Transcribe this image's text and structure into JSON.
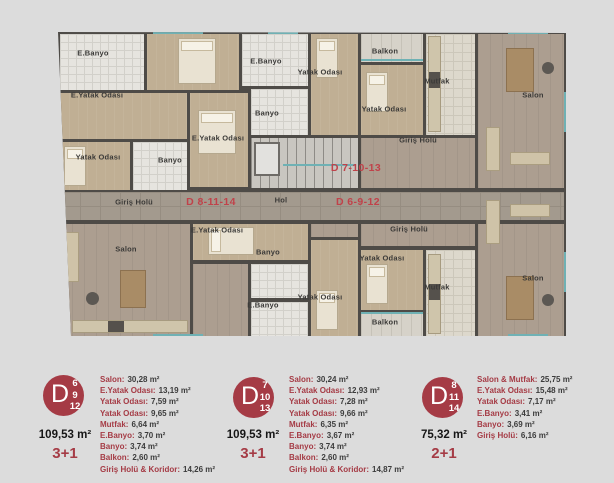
{
  "plan": {
    "room_labels": [
      {
        "text": "E.Banyo",
        "x": 35,
        "y": 21
      },
      {
        "text": "E.Yatak Odası",
        "x": 39,
        "y": 63
      },
      {
        "text": "Yatak Odası",
        "x": 40,
        "y": 125
      },
      {
        "text": "Banyo",
        "x": 112,
        "y": 128
      },
      {
        "text": "E.Banyo",
        "x": 208,
        "y": 29
      },
      {
        "text": "Yatak Odası",
        "x": 262,
        "y": 40
      },
      {
        "text": "Balkon",
        "x": 327,
        "y": 19
      },
      {
        "text": "Banyo",
        "x": 209,
        "y": 81
      },
      {
        "text": "Yatak Odası",
        "x": 326,
        "y": 77
      },
      {
        "text": "E.Yatak Odası",
        "x": 160,
        "y": 106
      },
      {
        "text": "Giriş Holü",
        "x": 360,
        "y": 108
      },
      {
        "text": "Mutfak",
        "x": 379,
        "y": 49
      },
      {
        "text": "Salon",
        "x": 475,
        "y": 63
      },
      {
        "text": "Giriş Holü",
        "x": 76,
        "y": 170
      },
      {
        "text": "Hol",
        "x": 223,
        "y": 168
      },
      {
        "text": "E.Yatak Odası",
        "x": 159,
        "y": 198
      },
      {
        "text": "Banyo",
        "x": 210,
        "y": 220
      },
      {
        "text": "Yatak Odası",
        "x": 324,
        "y": 226
      },
      {
        "text": "Giriş Holü",
        "x": 351,
        "y": 197
      },
      {
        "text": "Salon",
        "x": 68,
        "y": 217
      },
      {
        "text": "Yatak Odası",
        "x": 262,
        "y": 265
      },
      {
        "text": "E.Banyo",
        "x": 205,
        "y": 273
      },
      {
        "text": "Balkon",
        "x": 327,
        "y": 290
      },
      {
        "text": "Mutfak",
        "x": 379,
        "y": 255
      },
      {
        "text": "Salon",
        "x": 475,
        "y": 246
      }
    ],
    "unit_labels": [
      {
        "text": "D 8-11-14",
        "x": 153,
        "y": 170
      },
      {
        "text": "D 7-10-13",
        "x": 298,
        "y": 136
      },
      {
        "text": "D 6-9-12",
        "x": 300,
        "y": 170
      }
    ]
  },
  "units": [
    {
      "badge": {
        "letter": "D",
        "floors": [
          "6",
          "9",
          "12"
        ]
      },
      "rooms": [
        {
          "label": "Salon",
          "value": "30,28 m²"
        },
        {
          "label": "E.Yatak Odası",
          "value": "13,19 m²"
        },
        {
          "label": "Yatak Odası",
          "value": "7,59 m²"
        },
        {
          "label": "Yatak Odası",
          "value": "9,65 m²"
        },
        {
          "label": "Mutfak",
          "value": "6,64 m²"
        },
        {
          "label": "E.Banyo",
          "value": "3,70 m²"
        },
        {
          "label": "Banyo",
          "value": "3,74 m²"
        },
        {
          "label": "Balkon",
          "value": "2,60 m²"
        },
        {
          "label": "Giriş Holü & Koridor",
          "value": "14,26 m²"
        }
      ],
      "total": "109,53 m²",
      "type": "3+1"
    },
    {
      "badge": {
        "letter": "D",
        "floors": [
          "7",
          "10",
          "13"
        ]
      },
      "rooms": [
        {
          "label": "Salon",
          "value": "30,24 m²"
        },
        {
          "label": "E.Yatak Odası",
          "value": "12,93 m²"
        },
        {
          "label": "Yatak Odası",
          "value": "7,28 m²"
        },
        {
          "label": "Yatak Odası",
          "value": "9,66 m²"
        },
        {
          "label": "Mutfak",
          "value": "6,35 m²"
        },
        {
          "label": "E.Banyo",
          "value": "3,67 m²"
        },
        {
          "label": "Banyo",
          "value": "3,74 m²"
        },
        {
          "label": "Balkon",
          "value": "2,60 m²"
        },
        {
          "label": "Giriş Holü & Koridor",
          "value": "14,87 m²"
        }
      ],
      "total": "109,53 m²",
      "type": "3+1"
    },
    {
      "badge": {
        "letter": "D",
        "floors": [
          "8",
          "11",
          "14"
        ]
      },
      "rooms": [
        {
          "label": "Salon & Mutfak",
          "value": "25,75 m²"
        },
        {
          "label": "E.Yatak Odası",
          "value": "15,48 m²"
        },
        {
          "label": "Yatak Odası",
          "value": "7,17 m²"
        },
        {
          "label": "E.Banyo",
          "value": "3,41 m²"
        },
        {
          "label": "Banyo",
          "value": "3,69 m²"
        },
        {
          "label": "Giriş Holü",
          "value": "6,16 m²"
        }
      ],
      "total": "75,32 m²",
      "type": "2+1"
    }
  ],
  "colors": {
    "accent_red": "#a53b45",
    "plan_red": "#c0424a",
    "wall": "#4e4b47",
    "teal_window": "#6fb1b4"
  }
}
